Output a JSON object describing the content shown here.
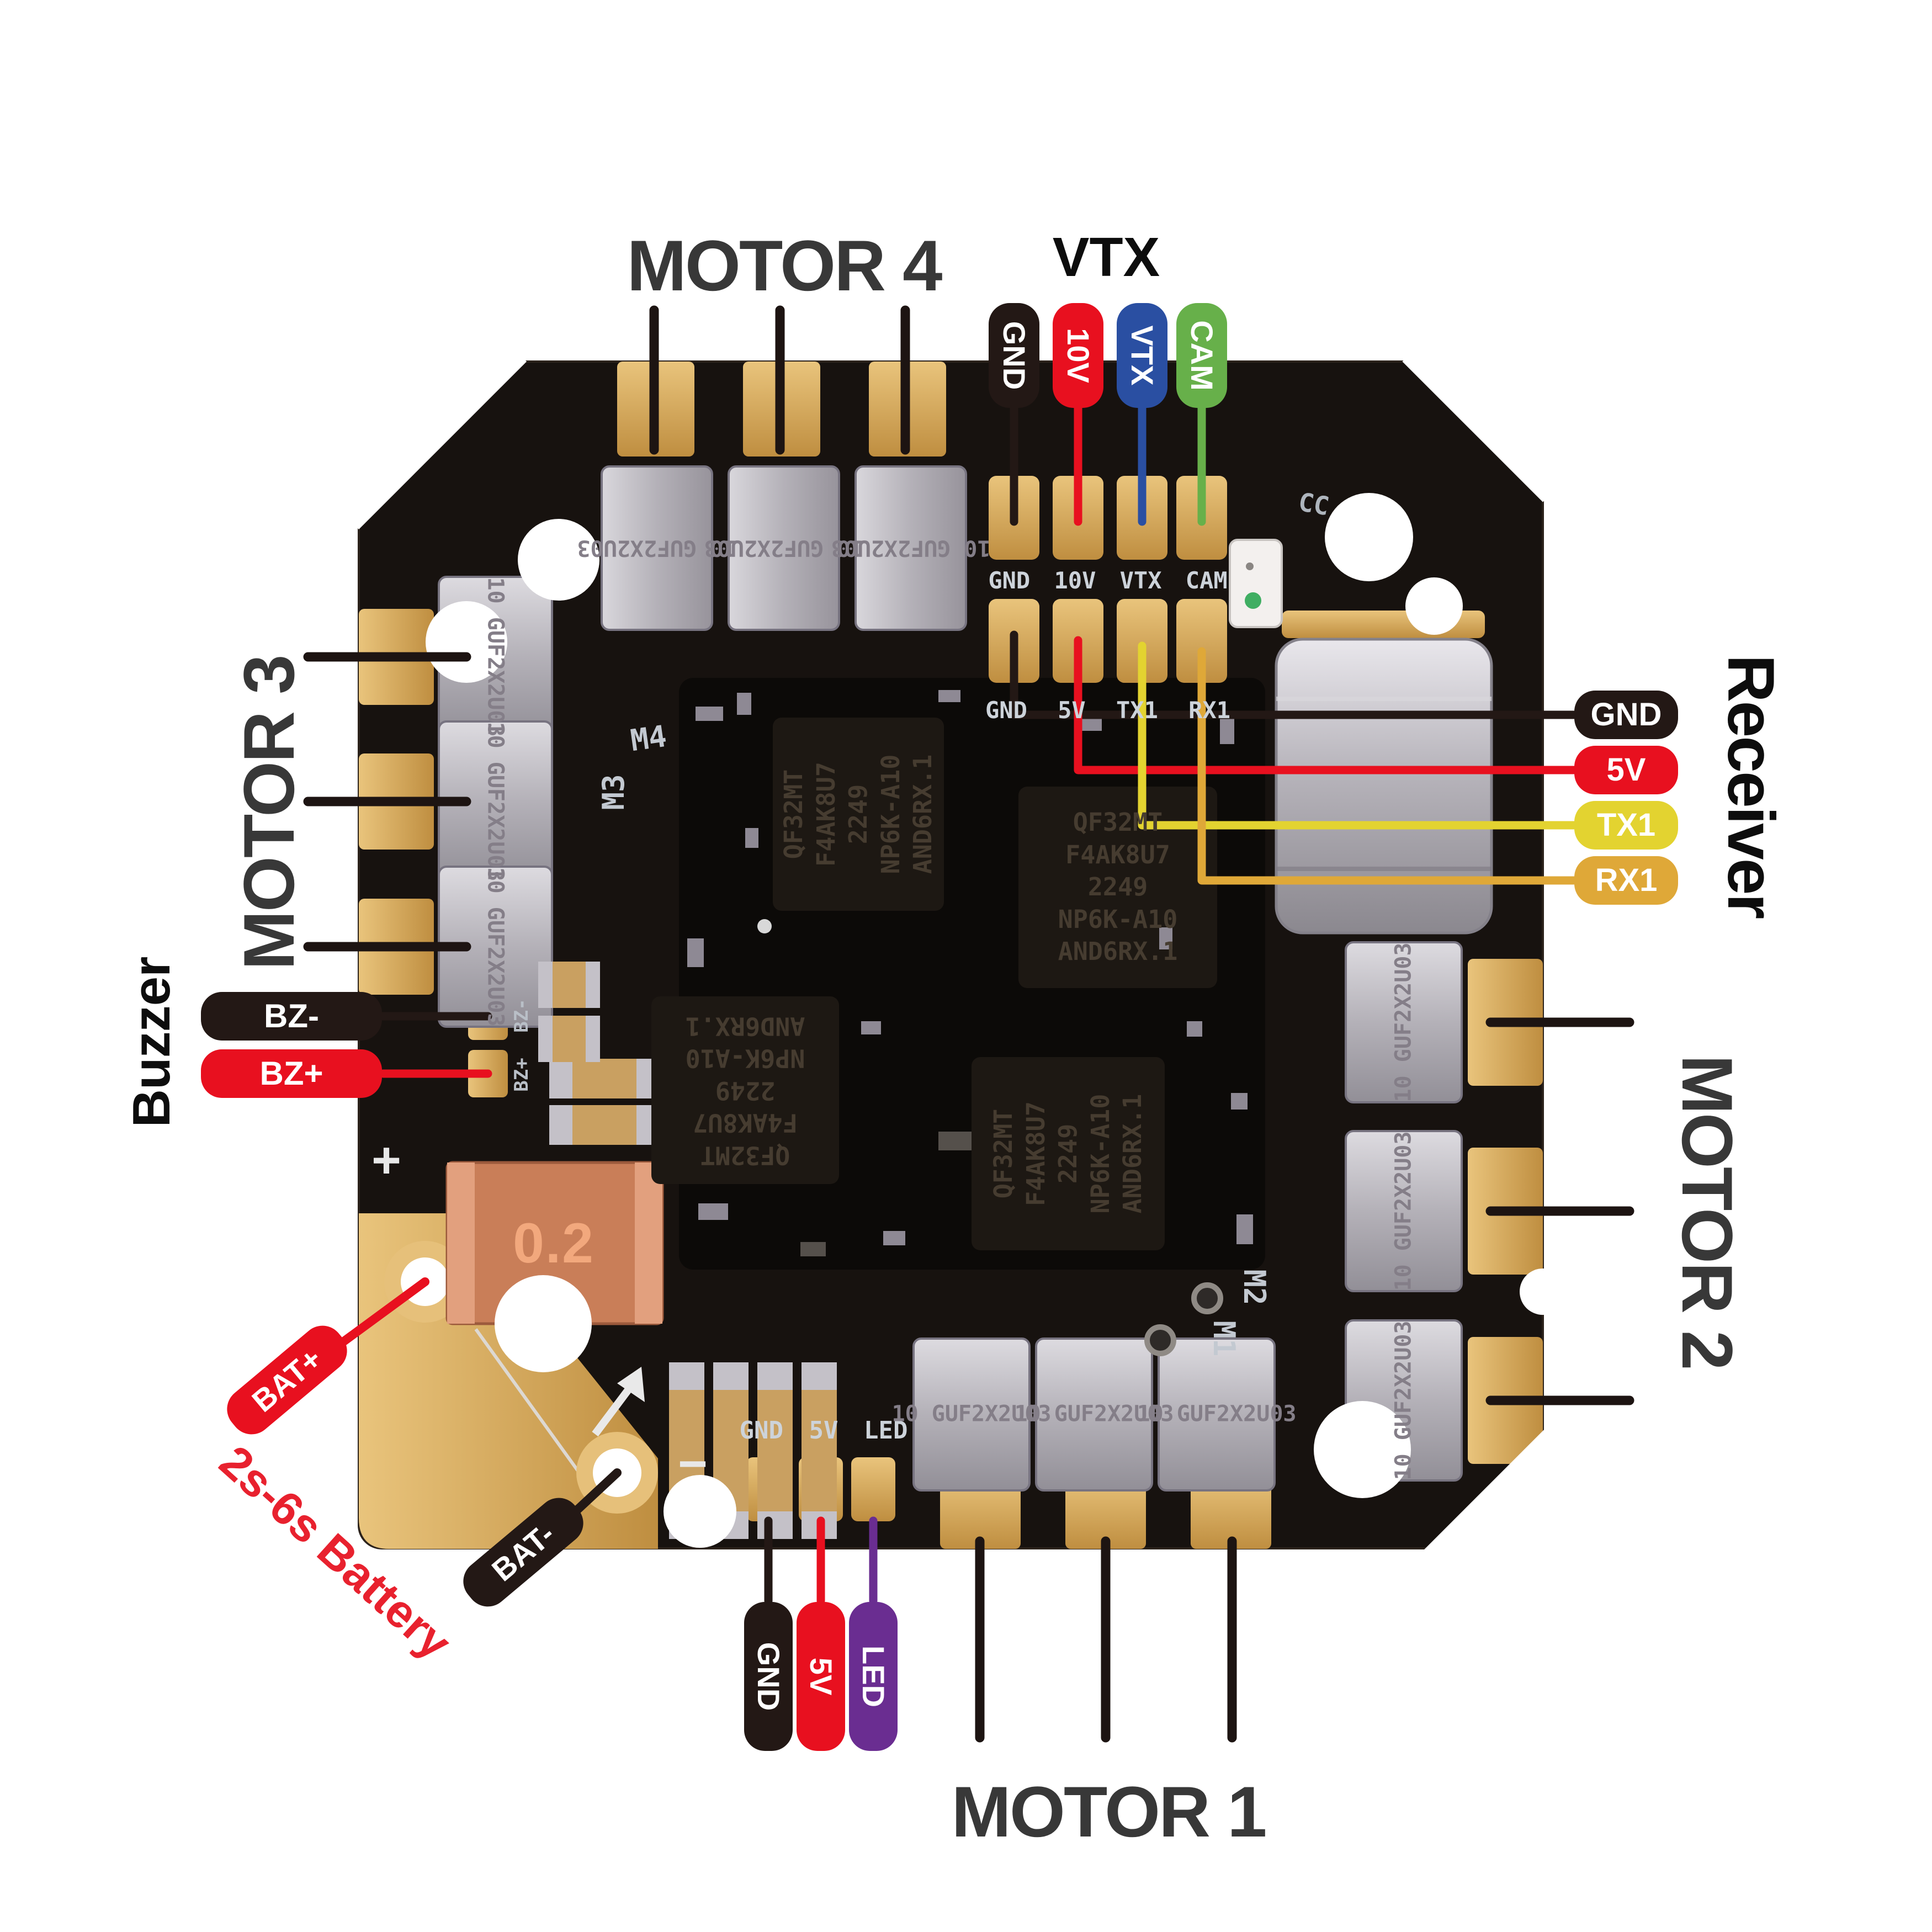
{
  "labels": {
    "motor1": "MOTOR 1",
    "motor2": "MOTOR 2",
    "motor3": "MOTOR 3",
    "motor4": "MOTOR 4",
    "vtx_header": "VTX",
    "receiver_header": "Receiver",
    "buzzer_header": "Buzzer",
    "battery_note": "2s-6s Battery"
  },
  "pins": {
    "vtx": [
      {
        "label": "GND",
        "color": "#231815"
      },
      {
        "label": "10V",
        "color": "#e8101f"
      },
      {
        "label": "VTX",
        "color": "#2a4fa2"
      },
      {
        "label": "CAM",
        "color": "#67b04a"
      }
    ],
    "receiver": [
      {
        "label": "GND",
        "color": "#231815"
      },
      {
        "label": "5V",
        "color": "#e8101f"
      },
      {
        "label": "TX1",
        "color": "#e3d330"
      },
      {
        "label": "RX1",
        "color": "#dfa838"
      }
    ],
    "buzzer": [
      {
        "label": "BZ-",
        "color": "#231815"
      },
      {
        "label": "BZ+",
        "color": "#e8101f"
      }
    ],
    "battery": [
      {
        "label": "BAT+",
        "color": "#e8101f"
      },
      {
        "label": "BAT-",
        "color": "#231815"
      }
    ],
    "led_strip": [
      {
        "label": "GND",
        "color": "#231815"
      },
      {
        "label": "5V",
        "color": "#e8101f"
      },
      {
        "label": "LED",
        "color": "#6a2d91"
      }
    ]
  },
  "silkscreen": {
    "vtx_row": "GND 10V VTX CAM",
    "uart_row": "GND 5V TX1 RX1",
    "led_row": "GND 5V LED",
    "m1": "M1",
    "m2": "M2",
    "m3": "M3",
    "m4": "M4",
    "cc": "CC",
    "plus": "+",
    "minus": "−",
    "bz_minus": "BZ-",
    "bz_plus": "BZ+",
    "shunt_value": "0.2"
  },
  "components": {
    "capacitor_line1": "10 GUF",
    "capacitor_line2": "2X2U03",
    "mcu_lines": [
      "QF32MT",
      "F4AK8U7",
      "2249",
      "NP6K-A10",
      "AND6RX.1"
    ]
  },
  "board_colors": {
    "pcb": "#17120f",
    "pad_gold": "#d9ab5c",
    "wire_black": "#231815",
    "wire_red": "#e8101f",
    "wire_blue": "#2a4fa2",
    "wire_green": "#67b04a",
    "wire_yellow": "#e3d330",
    "wire_gold": "#dfa838",
    "wire_purple": "#6a2d91",
    "battery_text_red": "#e8212e"
  }
}
